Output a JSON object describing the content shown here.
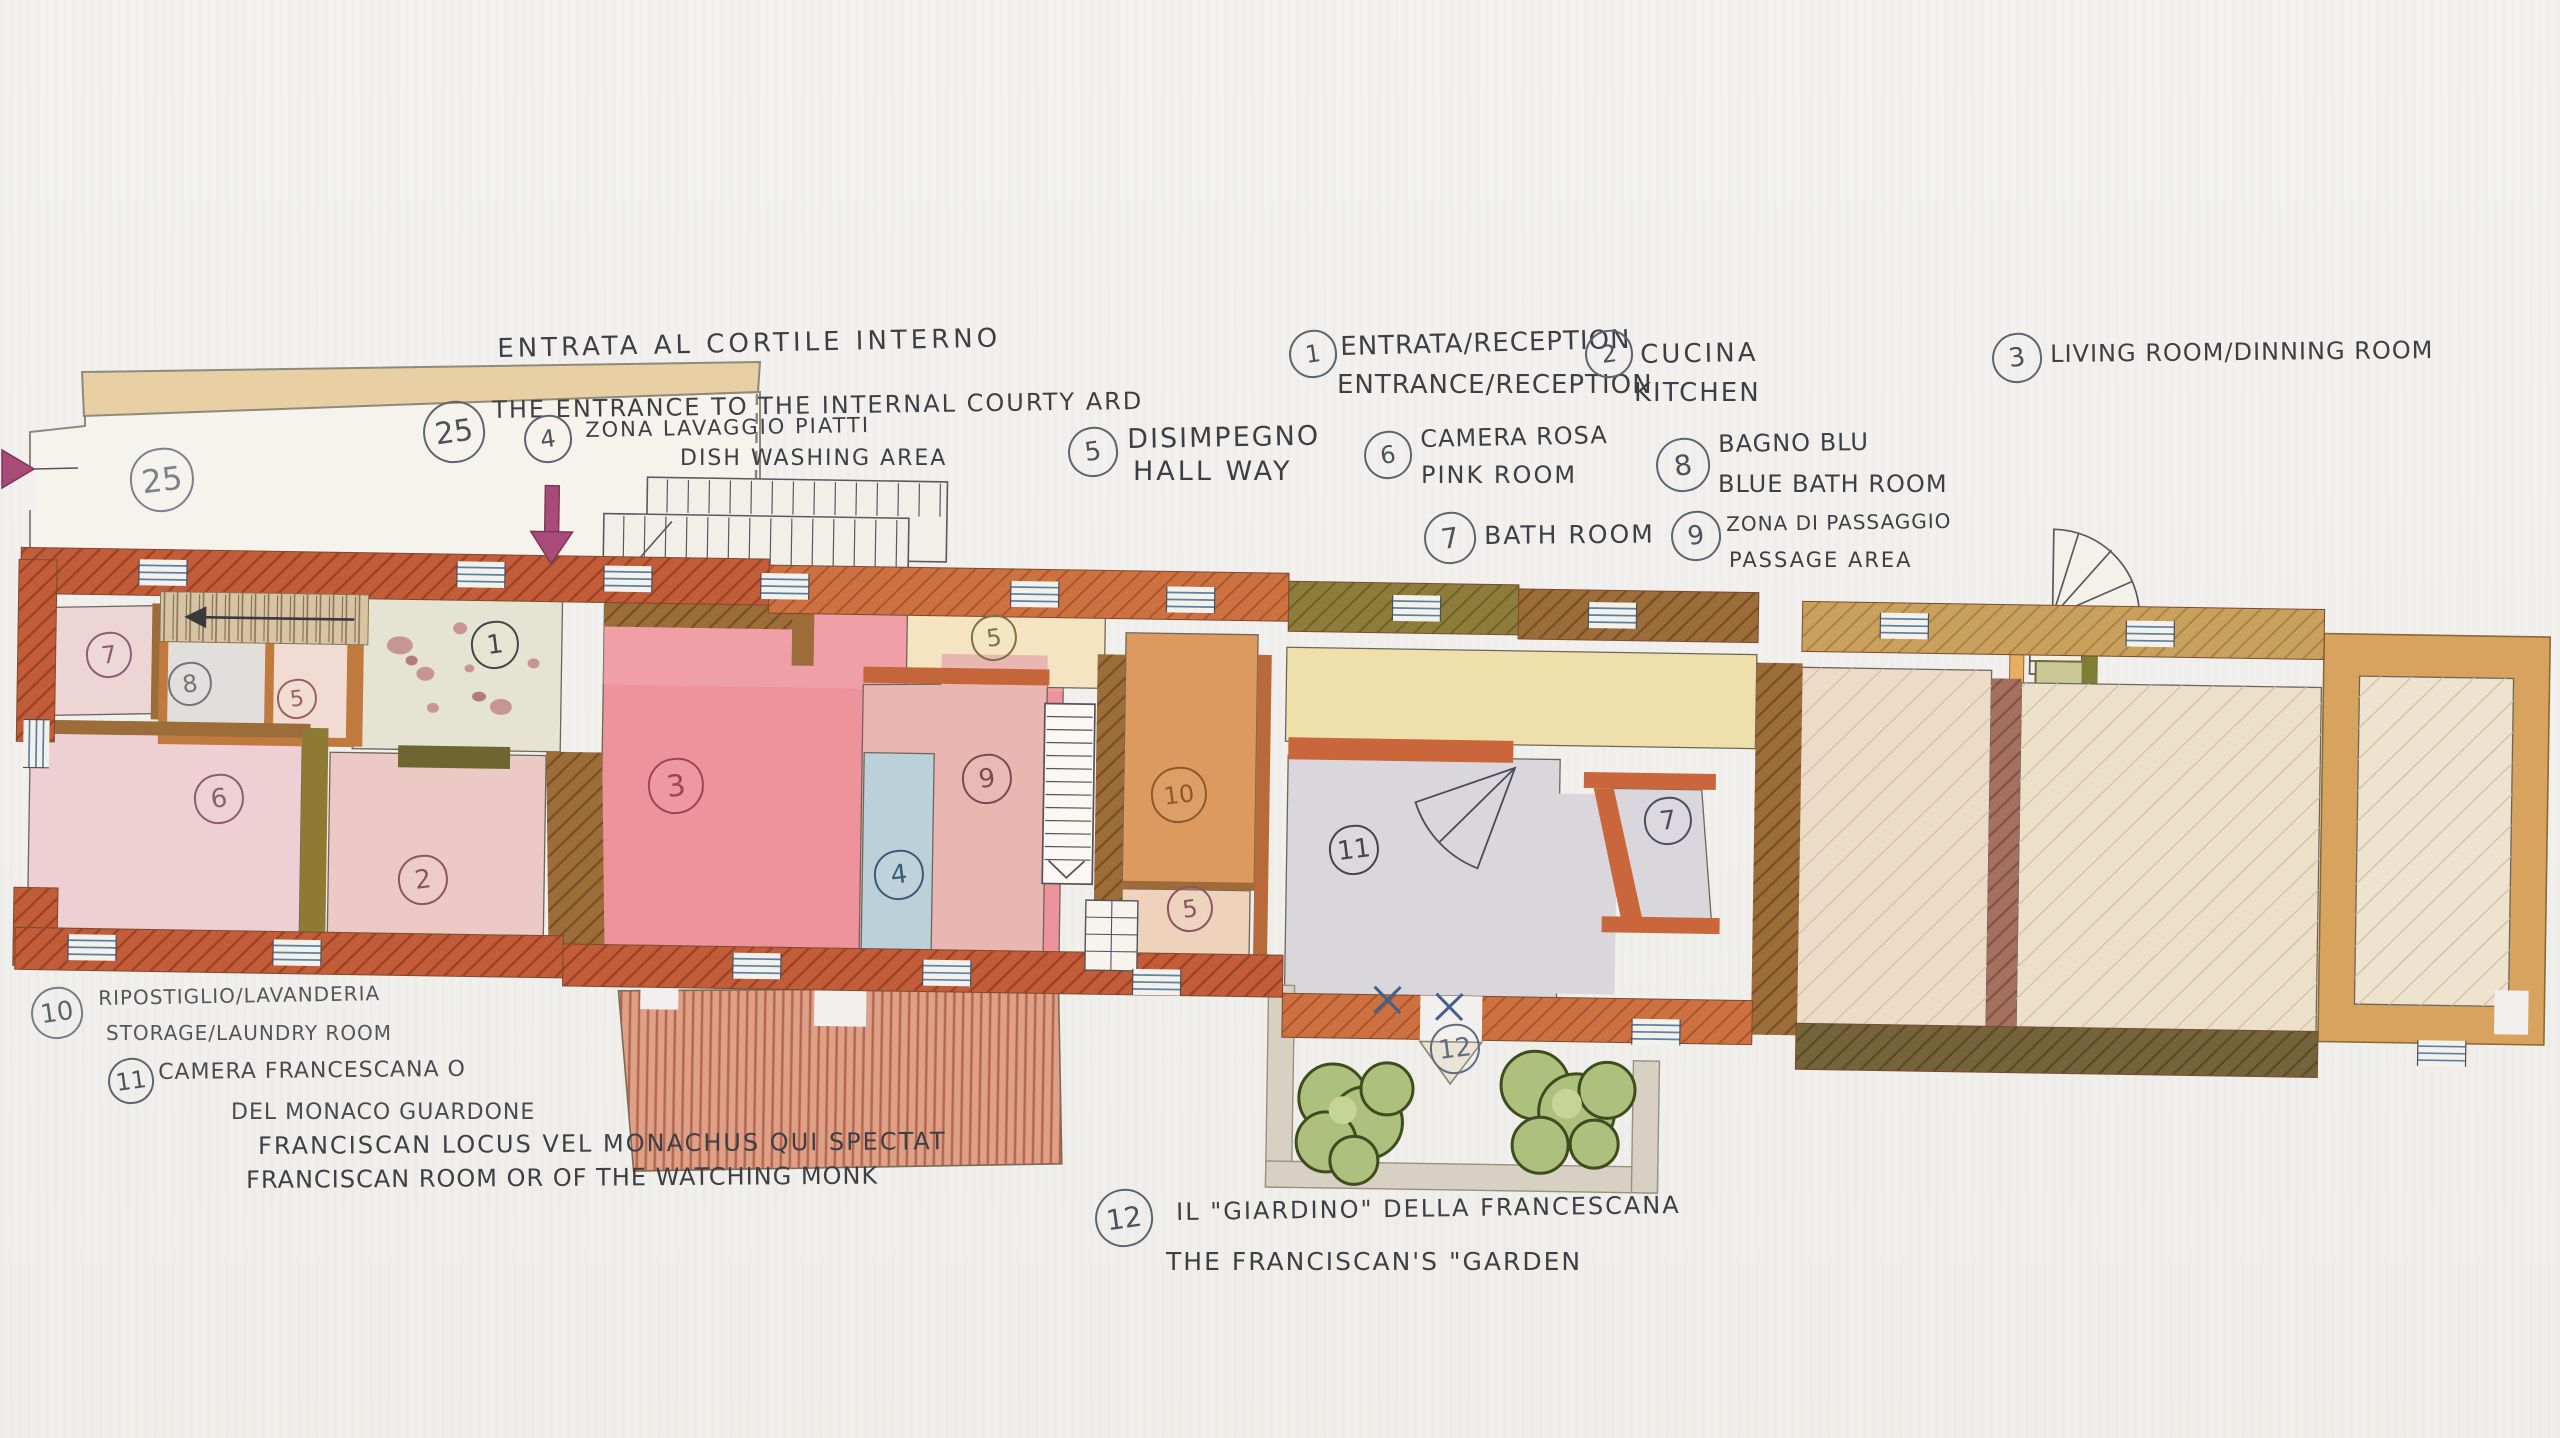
{
  "legend": {
    "courtyard": {
      "number": "25",
      "it": "ENTRATA AL CORTILE INTERNO",
      "en": "THE ENTRANCE TO THE INTERNAL COURTY ARD"
    },
    "dishwashing": {
      "number": "4",
      "it": "ZONA LAVAGGIO PIATTI",
      "en": "DISH WASHING AREA"
    },
    "hallway": {
      "number": "5",
      "it": "DISIMPEGNO",
      "en": "HALL WAY"
    },
    "reception": {
      "number": "1",
      "it": "ENTRATA/RECEPTION",
      "en": "ENTRANCE/RECEPTION"
    },
    "kitchen": {
      "number": "2",
      "it": "CUCINA",
      "en": "KITCHEN"
    },
    "living": {
      "number": "3",
      "en": "LIVING ROOM/DINNING ROOM"
    },
    "pinkroom": {
      "number": "6",
      "it": "CAMERA ROSA",
      "en": "PINK ROOM"
    },
    "bluebath": {
      "number": "8",
      "it": "BAGNO BLU",
      "en": "BLUE BATH ROOM"
    },
    "bathroom": {
      "number": "7",
      "en": "BATH ROOM"
    },
    "passage": {
      "number": "9",
      "it": "ZONA DI PASSAGGIO",
      "en": "PASSAGE AREA"
    },
    "storage": {
      "number": "10",
      "it": "RIPOSTIGLIO/LAVANDERIA",
      "en": "STORAGE/LAUNDRY ROOM"
    },
    "franciscan": {
      "number": "11",
      "it1": "CAMERA FRANCESCANA O",
      "it2": "DEL MONACO GUARDONE",
      "latin": "FRANCISCAN LOCUS VEL MONACHUS QUI SPECTAT",
      "en": "FRANCISCAN ROOM OR OF THE WATCHING MONK"
    },
    "garden": {
      "number": "12",
      "it": "IL \"GIARDINO\" DELLA FRANCESCANA",
      "en": "THE FRANCISCAN'S \"GARDEN"
    }
  },
  "plan": {
    "rooms": [
      {
        "n": "25",
        "x": 160,
        "y": 478,
        "d": 60,
        "ink": "#7a828c",
        "fs": 32
      },
      {
        "n": "7",
        "x": 107,
        "y": 653,
        "d": 42,
        "ink": "#8a5f74",
        "fs": 24
      },
      {
        "n": "8",
        "x": 188,
        "y": 682,
        "d": 40,
        "ink": "#70757d",
        "fs": 24
      },
      {
        "n": "5",
        "x": 295,
        "y": 697,
        "d": 36,
        "ink": "#9a6258",
        "fs": 22
      },
      {
        "n": "6",
        "x": 217,
        "y": 797,
        "d": 46,
        "ink": "#8a5f74",
        "fs": 26
      },
      {
        "n": "1",
        "x": 493,
        "y": 643,
        "d": 44,
        "ink": "#43454a",
        "fs": 26
      },
      {
        "n": "2",
        "x": 421,
        "y": 878,
        "d": 46,
        "ink": "#8d5560",
        "fs": 26
      },
      {
        "n": "3",
        "x": 674,
        "y": 784,
        "d": 52,
        "ink": "#a0435a",
        "fs": 30
      },
      {
        "n": "5",
        "x": 992,
        "y": 636,
        "d": 42,
        "ink": "#7c7342",
        "fs": 24
      },
      {
        "n": "9",
        "x": 985,
        "y": 777,
        "d": 46,
        "ink": "#7e4a50",
        "fs": 26
      },
      {
        "n": "4",
        "x": 897,
        "y": 873,
        "d": 46,
        "ink": "#3d5a74",
        "fs": 26
      },
      {
        "n": "10",
        "x": 1177,
        "y": 793,
        "d": 52,
        "ink": "#8a5a2e",
        "fs": 24
      },
      {
        "n": "5",
        "x": 1188,
        "y": 907,
        "d": 42,
        "ink": "#8d5560",
        "fs": 24
      },
      {
        "n": "11",
        "x": 1352,
        "y": 848,
        "d": 46,
        "ink": "#43454a",
        "fs": 26
      },
      {
        "n": "7",
        "x": 1666,
        "y": 819,
        "d": 44,
        "ink": "#4a4f58",
        "fs": 26
      },
      {
        "n": "12",
        "x": 1453,
        "y": 1047,
        "d": 46,
        "ink": "#5f6d7e",
        "fs": 26
      }
    ]
  },
  "colors": {
    "paper": "#f1f0ee",
    "pencil": "#3d3f45",
    "terracotta": "#c25c39",
    "wall_brown": "#9c6d38",
    "wall_olive": "#8e7a33",
    "wall_tan": "#d7a35f",
    "room_pink": "#eecfd3",
    "room_red": "#ee939c",
    "room_blue": "#bcd0da",
    "room_orange": "#dd9a5e",
    "room_gray": "#dad7dc",
    "corridor_yellow": "#efe0ab",
    "garden_green": "#aec07e",
    "arrow_magenta": "#a94b78"
  }
}
